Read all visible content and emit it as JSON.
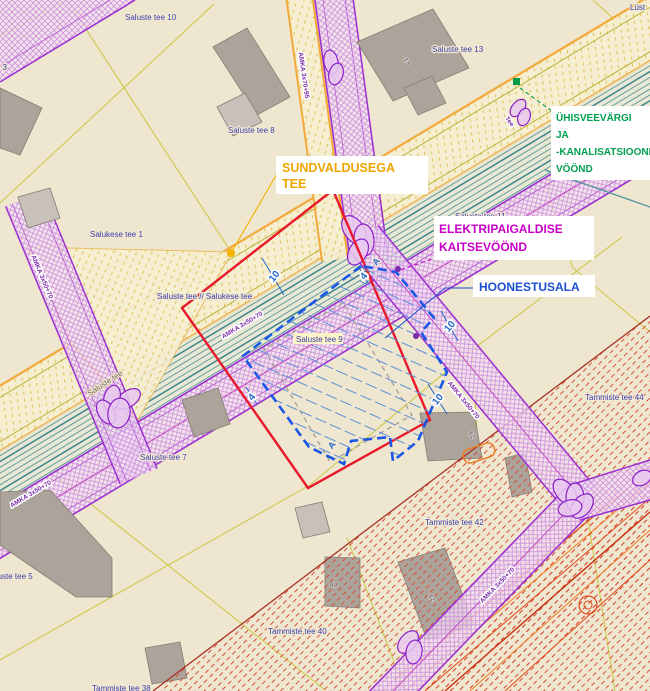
{
  "map_labels": {
    "parcels": {
      "saluste_tee_10": "Saluste tee 10",
      "saluste_tee_8": "Saluste tee 8",
      "saluste_tee_13": "Saluste tee 13",
      "saluste_tee_11": "Saluste tee 11",
      "saluste_tee_9": "Saluste tee 9",
      "saluste_tee_7": "Saluste tee 7",
      "saluste_tee_5": "Saluste tee 5",
      "saluste_tee_3": "Saluste tee 3",
      "salukese_tee_1": "Salukese tee 1",
      "saluste_salukese_junction": "Saluste tee // Salukese tee",
      "tammiste_tee_38": "Tammiste tee 38",
      "tammiste_tee_40": "Tammiste tee 40",
      "tammiste_tee_42": "Tammiste tee 42",
      "tammiste_tee_44": "Tammiste tee 44",
      "edge_partial_top_right": "Lüst"
    },
    "roads": {
      "saluste_tee": "Saluste tee",
      "tee_cap": "Tee"
    },
    "buildings": {
      "b13": "13",
      "b42": "42",
      "b40": "40"
    },
    "cables": {
      "amka_50_70": "AMKA 3x50+70",
      "amka_70_95": "AMKA 3x70+95"
    },
    "dimensions": {
      "ten": "10",
      "four": "4",
      "section": "A"
    }
  },
  "callouts": {
    "sundvaldusega_tee": {
      "lines": [
        "SUNDVALDUSEGA",
        "TEE"
      ],
      "color": "#F0A500"
    },
    "uhisveevark": {
      "lines": [
        "ÜHISVEEVÄRGI",
        "JA",
        "-KANALISATSIOONI",
        "VÖÖND"
      ],
      "color": "#00A050"
    },
    "elektripaigaldis": {
      "lines": [
        "ELEKTRIPAIGALDISE",
        "KAITSEVÖÖND"
      ],
      "color": "#C800C8"
    },
    "hoonestusala": {
      "lines": [
        "HOONESTUSALA"
      ],
      "color": "#1B50D0"
    }
  },
  "colors": {
    "background": "#EFE6D0",
    "parcel_line_yellow": "#C9C83E",
    "road_edge_orange": "#F2A93B",
    "water_sewer_teal": "#59959B",
    "electrical_purple": "#9B30D0",
    "sundvaldus_red": "#E8192C",
    "hoonestus_blue": "#1A56E8",
    "restriction_red_hatch": "#D4503A",
    "building_gray": "#ACA49B"
  }
}
